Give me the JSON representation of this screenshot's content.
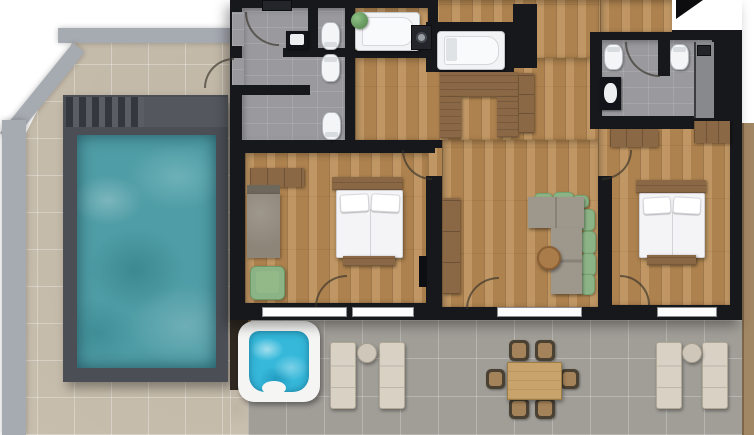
{
  "meta": {
    "kind": "rendered apartment floor plan, top-down view",
    "width_px": 754,
    "height_px": 435,
    "visible_text": "none"
  },
  "palette": {
    "outside": "#ffffff",
    "boundary-wall": "#a6aab1",
    "deck-tile": "#c9bfae",
    "terrace-tile": "#a19e98",
    "bath-tile": "#9a9a9e",
    "wood-floor": "#b68a55",
    "wood-furn": "#8a6845",
    "wall": "#17181b",
    "pool-surround": "#4b4f55",
    "pool-water": "#4f9da6",
    "hot-tub-water": "#35b8da",
    "fixture-white": "#f2f3f5",
    "sofa-gray": "#9d978c",
    "cushion-green": "#8cb386",
    "lounger": "#d8d1c4",
    "bed-white": "#f4f4f6",
    "divider": "#2e2820",
    "east-strip": "#a28764",
    "table-wood": "#c8a36b",
    "arrow": "#0d0d0f"
  },
  "inventory": {
    "outdoor": {
      "swimming_pool": 1,
      "pool_steps": 1,
      "hot_tub": 1,
      "sun_loungers": 4,
      "lounger_side_tables": 2,
      "dining_table": 1,
      "dining_chairs": 6
    },
    "rooms": [
      "pool terrace",
      "bathroom-left",
      "bathroom-center",
      "bathroom-right",
      "bathtub room",
      "kitchenette",
      "hallway",
      "bedroom-1",
      "living room",
      "bedroom-2",
      "rear terrace"
    ],
    "indoor_fixtures": {
      "double_beds": 2,
      "bathtubs": 2,
      "toilets": 5,
      "washbasins": 3,
      "washing_machine": 1,
      "shower": 1,
      "sofa_sectional": 1,
      "coffee_table": 1,
      "sideboard": 1,
      "armchair": 1,
      "daybed": 1,
      "wardrobes": 3,
      "radiator": 1,
      "wall_tv": 1,
      "north_arrow": 1,
      "door_swings": 8
    }
  }
}
